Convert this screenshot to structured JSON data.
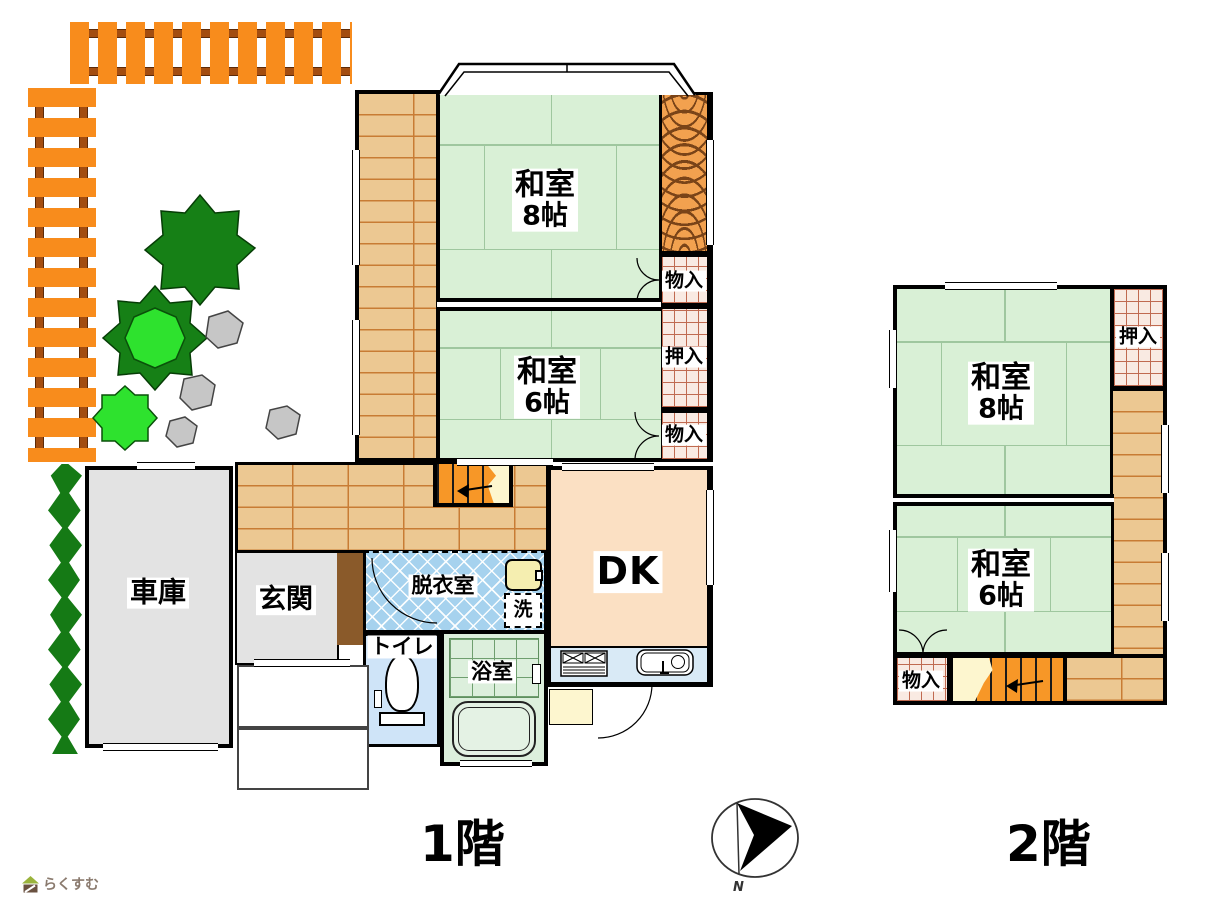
{
  "floor1": {
    "title": "1階",
    "washitsu8": {
      "name": "和室",
      "size": "8帖"
    },
    "washitsu6": {
      "name": "和室",
      "size": "6帖"
    },
    "monoire_top": "物入",
    "oshiire": "押入",
    "monoire_bottom": "物入",
    "dk": "DK",
    "datsuishitsu": "脱衣室",
    "laundry": "洗",
    "toilet": "トイレ",
    "bath": "浴室",
    "genkan": "玄関",
    "garage": "車庫"
  },
  "floor2": {
    "title": "2階",
    "washitsu8": {
      "name": "和室",
      "size": "8帖"
    },
    "washitsu6": {
      "name": "和室",
      "size": "6帖"
    },
    "oshiire": "押入",
    "monoire": "物入"
  },
  "compass": {
    "north": "N"
  },
  "watermark": {
    "brand": "らくすむ"
  },
  "palette": {
    "tatami": "#d9f0d6",
    "wood_floor": "#ecc892",
    "wood_line": "#c87c34",
    "tokonoma_grain": "#f2a14f",
    "storage_bg": "#f9eae2",
    "storage_grid": "#c06a50",
    "dk": "#fbe0c3",
    "kitchen_counter": "#d9eaf6",
    "dressing_tile": "#a6d2ee",
    "toilet": "#cfe4f8",
    "bath": "#dcefdc",
    "garage_gray": "#e3e3e3",
    "shoe_cabinet": "#8a5a2a",
    "stairs_orange": "#f79727",
    "step_cream": "#fdf6cf",
    "fence_orange": "#f88c1c",
    "fence_rail": "#a34d10",
    "hedge_green": "#157a15",
    "tree_dark": "#168016",
    "tree_bright": "#2ee22e",
    "stone_gray": "#c6c6c6"
  }
}
